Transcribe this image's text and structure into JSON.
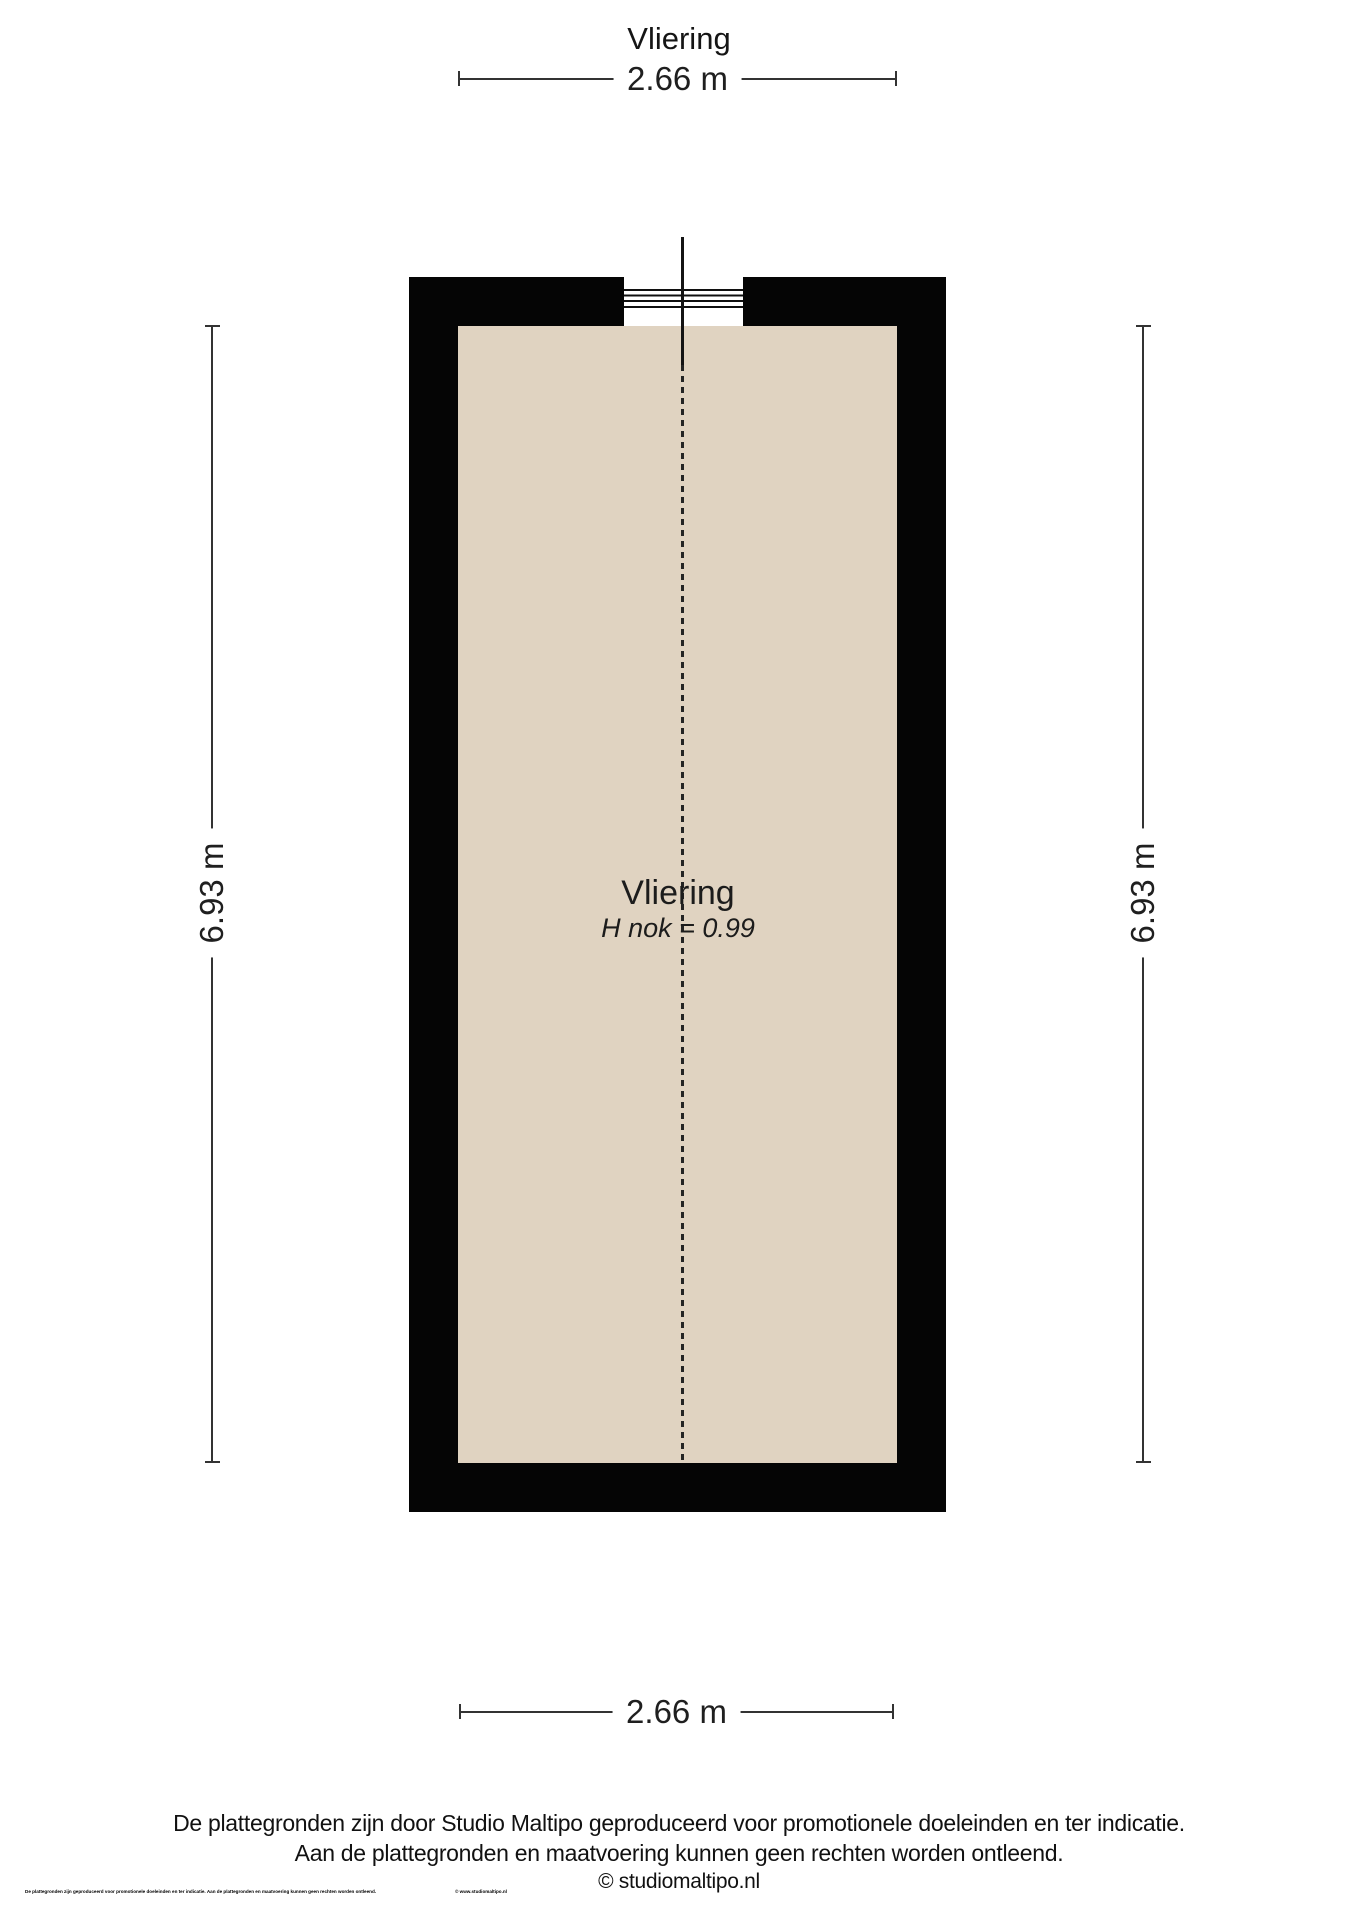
{
  "page": {
    "title": "Vliering"
  },
  "plan": {
    "room": {
      "name": "Vliering",
      "height_note": "H nok = 0.99"
    },
    "dimensions": {
      "top": "2.66 m",
      "bottom": "2.66 m",
      "left": "6.93 m",
      "right": "6.93 m"
    }
  },
  "footer": {
    "disclaimer_line1": "De plattegronden zijn door Studio Maltipo geproduceerd voor promotionele doeleinden en ter indicatie.",
    "disclaimer_line2": "Aan de plattegronden en maatvoering kunnen geen rechten worden ontleend.",
    "copyright": "© studiomaltipo.nl",
    "fineprint": "De plattegronden zijn geproduceerd voor promotionele doeleinden en ter indicatie. Aan de plattegronden en maatvoering kunnen geen rechten worden ontleend.",
    "fineprint_copyright": "©  www.studiomaltipo.nl"
  },
  "colors": {
    "wall": "#050505",
    "floor": "#e0d3c1",
    "line": "#333333",
    "text": "#1a1a1a"
  }
}
